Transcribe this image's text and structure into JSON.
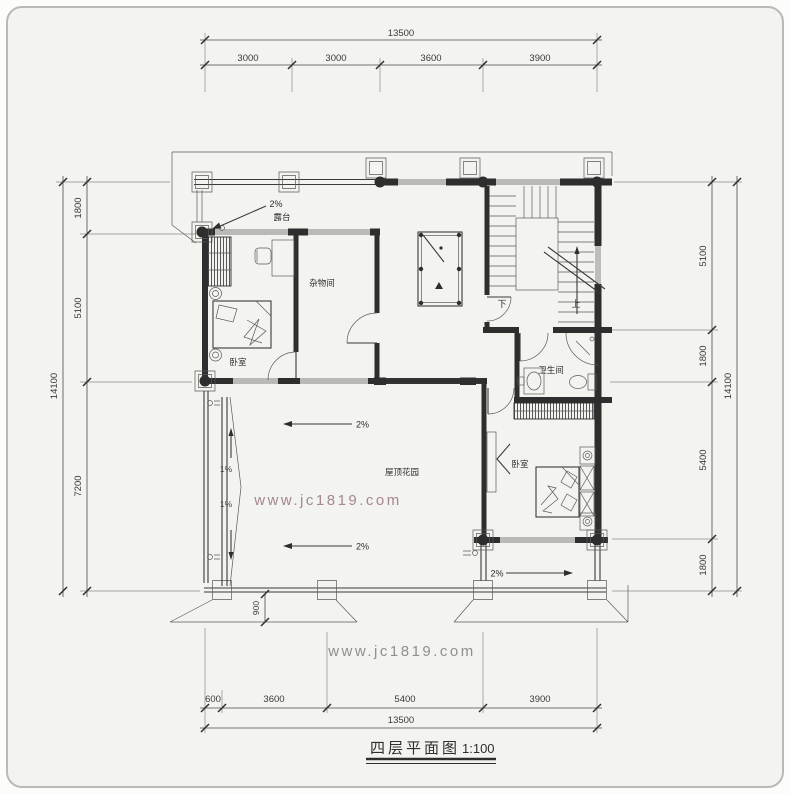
{
  "drawing": {
    "title": "四层平面图",
    "title_scale": "1:100",
    "watermark_center": "www.jc1819.com",
    "watermark_bottom": "www.jc1819.com"
  },
  "rooms": {
    "terrace": "露台",
    "storage": "杂物间",
    "bedroom1": "卧室",
    "bathroom": "卫生间",
    "bedroom2": "卧室",
    "roof_garden": "屋顶花园"
  },
  "stairs": {
    "down": "下",
    "up": "上"
  },
  "slopes": {
    "terrace": "2%",
    "garden_upper": "2%",
    "garden_lower": "2%",
    "drain_upper": "1%",
    "drain_lower": "1%",
    "bedroom2_south": "2%"
  },
  "dimensions": {
    "top": {
      "total": "13500",
      "segments": [
        "3000",
        "3000",
        "3600",
        "3900"
      ]
    },
    "bottom": {
      "total": "13500",
      "segments": [
        "600",
        "3600",
        "5400",
        "3900"
      ]
    },
    "left": {
      "total": "14100",
      "segments": [
        "1800",
        "5100",
        "7200"
      ]
    },
    "right": {
      "total": "14100",
      "segments": [
        "5100",
        "1800",
        "5400",
        "1800"
      ]
    },
    "eave_offset": "900"
  },
  "colors": {
    "line": "#3a3a3a",
    "background": "#f3f3ef",
    "panel_border": "#b9b9b6",
    "watermark_center": "#a5878e",
    "watermark_bottom": "#8f8f8f"
  }
}
